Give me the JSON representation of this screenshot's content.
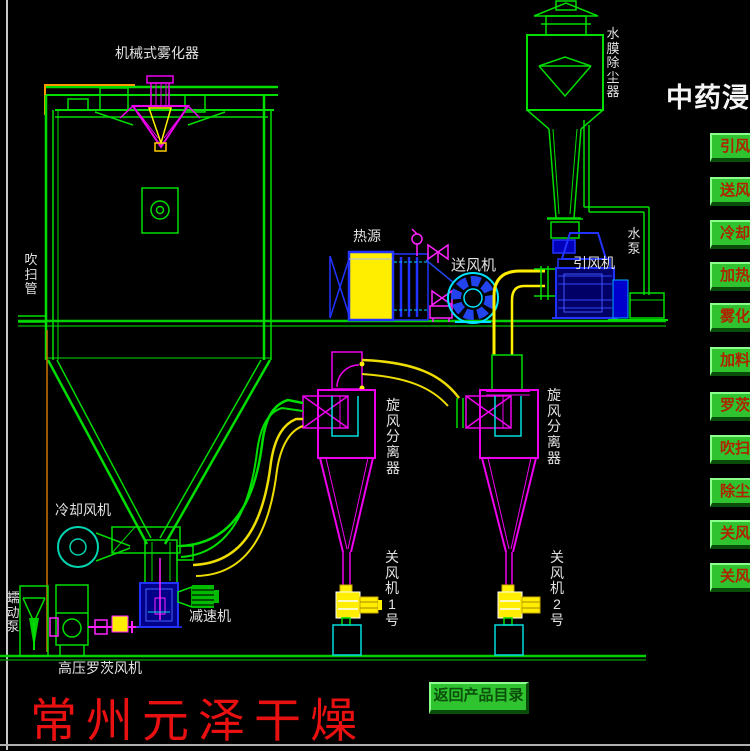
{
  "panel": {
    "title": "中药浸膏",
    "buttons": [
      {
        "label": "引风"
      },
      {
        "label": "送风"
      },
      {
        "label": "冷却"
      },
      {
        "label": "加热"
      },
      {
        "label": "雾化"
      },
      {
        "label": "加料"
      },
      {
        "label": "罗茨"
      },
      {
        "label": "吹扫"
      },
      {
        "label": "除尘"
      },
      {
        "label": "关风"
      },
      {
        "label": "关风"
      }
    ]
  },
  "labels": {
    "atomizer": "机械式雾化器",
    "dust_collector": "水膜除尘器",
    "purge_pipe": "吹扫管",
    "heat_source": "热源",
    "supply_fan": "送风机",
    "induced_fan": "引风机",
    "water_pump": "水泵",
    "cyclone1": "旋风分离器",
    "cyclone2": "旋风分离器",
    "cooling_fan": "冷却风机",
    "feed_pump": "蠕动泵",
    "reducer": "减速机",
    "roots_blower": "高压罗茨风机",
    "rotary_valve1": "关风机1号",
    "rotary_valve2": "关风机2号"
  },
  "footer": {
    "brand": "常州元泽干燥",
    "return_button": "返回产品目录"
  },
  "colors": {
    "line_green": "#00dd00",
    "magenta": "#ee00ee",
    "yellow": "#ffee00",
    "cyan": "#00e5ff",
    "blue": "#2233ff",
    "button_green": "#2fc42f",
    "button_text_red": "#b02300",
    "brand_red": "#e81010",
    "background": "#000000"
  }
}
